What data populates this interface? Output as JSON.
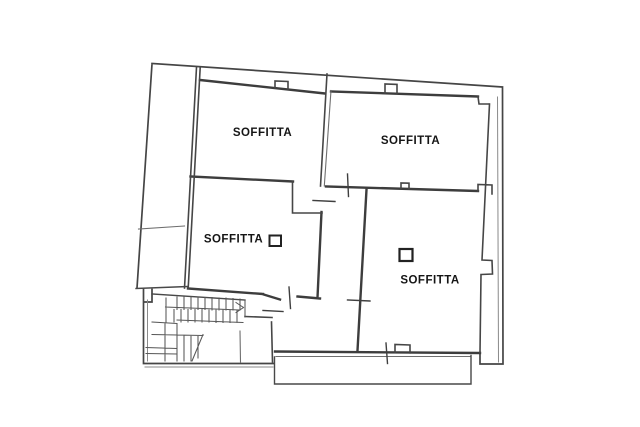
{
  "plan": {
    "background_color": "#ffffff",
    "wall_color": "#3f3f3f",
    "label_color": "#151515",
    "rooms": [
      {
        "id": "soffitta-top-left",
        "label": "SOFFITTA",
        "symbol": null
      },
      {
        "id": "soffitta-top-right",
        "label": "SOFFITTA",
        "symbol": null
      },
      {
        "id": "soffitta-middle-left",
        "label": "SOFFITTA",
        "symbol": "square-fixture"
      },
      {
        "id": "soffitta-bottom-right",
        "label": "SOFFITTA",
        "symbol": "square-fixture"
      }
    ]
  }
}
